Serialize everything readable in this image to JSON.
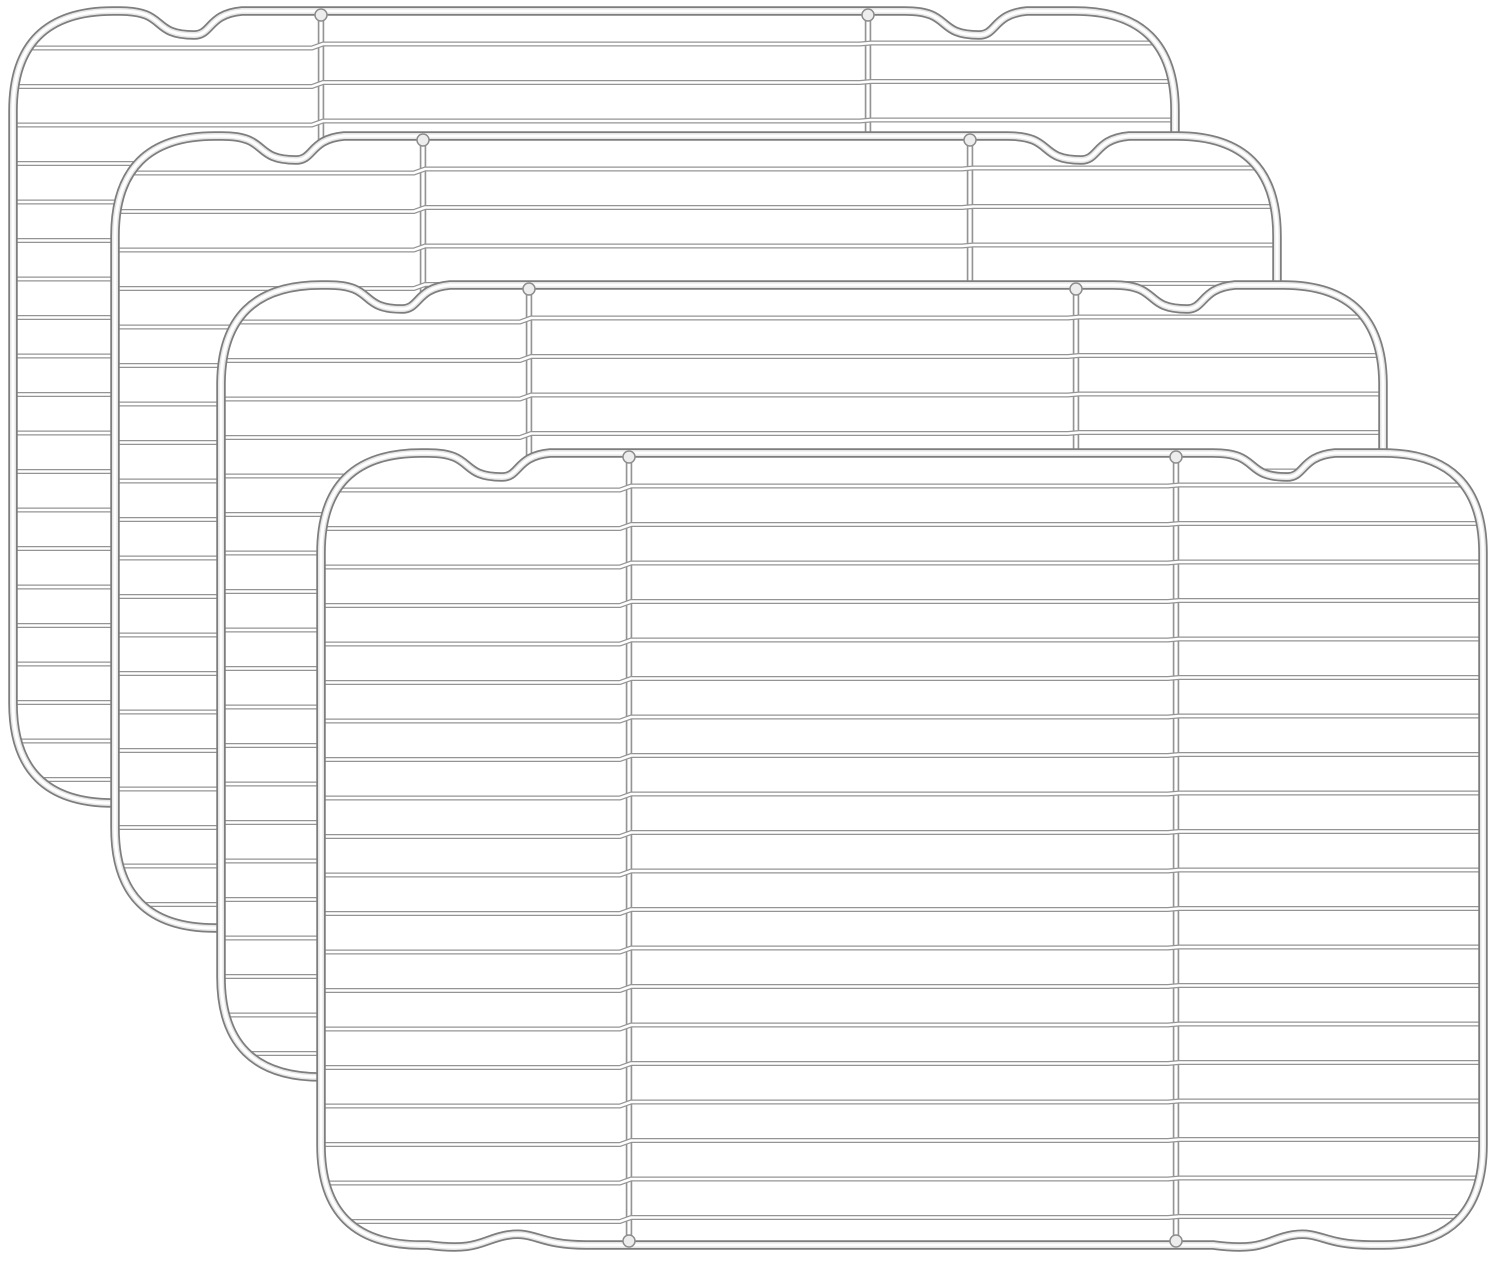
{
  "scene": {
    "description": "Product photo of four identical stainless steel wire cooling/baking racks fanned diagonally from top-left (back) to bottom-right (front) on a plain white background",
    "background_color": "#ffffff",
    "rack_count": 4,
    "material_look": "polished chrome wire: white tube cores with thin gray outlines"
  },
  "canvas": {
    "width": 1500,
    "height": 1263
  },
  "colors": {
    "background": "#ffffff",
    "wire_outline": "#949494",
    "wire_core": "#ffffff",
    "frame_outline": "#7e7e7e",
    "frame_mid": "#e6e6e6",
    "frame_core": "#ffffff",
    "weld_fill": "#ededed",
    "weld_stroke": "#8d8d8d",
    "rack_fill": "#ffffff"
  },
  "rack_geometry": {
    "width": 1172,
    "height": 802,
    "edge_inset": 5,
    "corner_radius": 100,
    "frame_stroke_outer_width": 9.5,
    "frame_stroke_mid_width": 6,
    "frame_stroke_core_width": 3,
    "top_notch_centers_x": [
      190,
      975
    ],
    "top_notch_depth": 24,
    "bottom_wave_centers_x": [
      190,
      975
    ],
    "bottom_wave_amplitude": 11,
    "vertical_bar_positions_x": [
      313,
      860
    ],
    "bar_outline_width": 6.5,
    "bar_core_width": 3.2,
    "weld_radius": 6,
    "wire_count": 20,
    "first_wire_y": 37,
    "wire_spacing": 38.5,
    "wire_outline_width": 5,
    "wire_core_width": 2.6,
    "wire_segments": [
      [
        6,
        304,
        5
      ],
      [
        315,
        852,
        1
      ],
      [
        863,
        1166,
        0
      ]
    ]
  },
  "racks": [
    {
      "name": "cooling-rack-1-back",
      "x": 8,
      "y": 6
    },
    {
      "name": "cooling-rack-2",
      "x": 110,
      "y": 131
    },
    {
      "name": "cooling-rack-3",
      "x": 216,
      "y": 280
    },
    {
      "name": "cooling-rack-4-front",
      "x": 316,
      "y": 448
    }
  ]
}
